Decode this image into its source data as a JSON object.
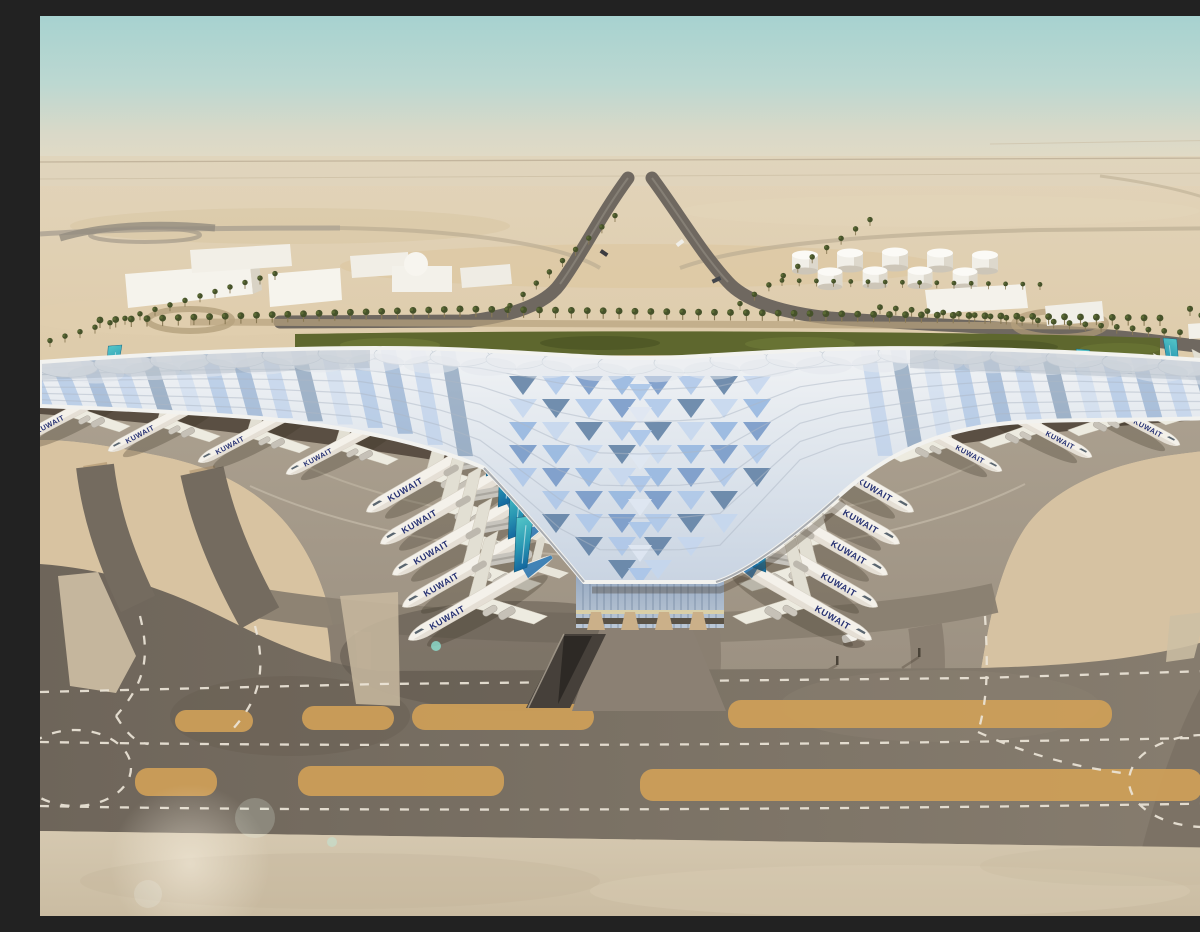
{
  "meta": {
    "title": "Aerial rendering of a desert airport terminal",
    "description": "Architectural visualization: trefoil terminal with swooping photovoltaic roof, Kuwait Airways aircraft at gates, palm-lined approach roads, desert horizon, taxiways in foreground"
  },
  "scene": {
    "airline_title": "KUWAIT",
    "palette": {
      "sky_top": "#a7d2d0",
      "sky_haze": "#ded8c6",
      "desert": "#ddc9a8",
      "desert_gold": "#d9bd92",
      "hedge_green": "#5e672e",
      "palm_green": "#46522a",
      "roof_silver": "#e9ecef",
      "roof_wing_gray": "#97a2b0",
      "apron_concrete": "#a59a8a",
      "taxiway_asphalt": "#786f63",
      "runway_gold": "#cf9f58",
      "sand_wedge": "#d8c3a1",
      "canopy_shadow": "#4c4136",
      "structure_tan": "#c9a46d",
      "fin_teal": "#3fb6ba",
      "fin_deep_blue": "#146ba3",
      "livery_navy": "#273273",
      "roof_blues": [
        "#8fb2de",
        "#6e93c4",
        "#a9c4e8",
        "#57799f",
        "#c3d6ee"
      ]
    },
    "aircraft": {
      "groups": [
        {
          "name": "left-center-gates",
          "dir": "left",
          "rot": -30,
          "scale": 1.12,
          "bridge": true,
          "positions": [
            [
              402,
              452
            ],
            [
              416,
              484
            ],
            [
              428,
              515
            ],
            [
              438,
              547
            ],
            [
              444,
              580
            ]
          ]
        },
        {
          "name": "right-center-gates",
          "dir": "right",
          "rot": 30,
          "scale": 1.12,
          "bridge": true,
          "positions": [
            [
              798,
              452
            ],
            [
              784,
              484
            ],
            [
              772,
              515
            ],
            [
              762,
              547
            ],
            [
              756,
              580
            ]
          ]
        },
        {
          "name": "left-wing-gates",
          "dir": "left",
          "rot": -28,
          "scale": 0.9,
          "bridge": true,
          "positions": [
            [
              40,
              392
            ],
            [
              130,
              402
            ],
            [
              220,
              413
            ],
            [
              308,
              425
            ]
          ]
        },
        {
          "name": "right-wing-gates",
          "dir": "right",
          "rot": 28,
          "scale": 0.9,
          "bridge": true,
          "positions": [
            [
              1165,
              385
            ],
            [
              1078,
              396
            ],
            [
              990,
              408
            ],
            [
              900,
              422
            ]
          ]
        }
      ]
    },
    "vegetation": {
      "palm_rows": [
        {
          "from": [
            60,
            312
          ],
          "to": [
            420,
            301
          ],
          "count": 24,
          "scale": 1.0
        },
        {
          "from": [
            420,
            301
          ],
          "to": [
            1120,
            310
          ],
          "count": 45,
          "scale": 1.0
        },
        {
          "from": [
            10,
            331
          ],
          "to": [
            235,
            264
          ],
          "count": 16,
          "scale": 0.8
        },
        {
          "from": [
            470,
            296
          ],
          "to": [
            575,
            206
          ],
          "count": 9,
          "scale": 0.8
        },
        {
          "from": [
            700,
            294
          ],
          "to": [
            830,
            210
          ],
          "count": 10,
          "scale": 0.8
        },
        {
          "from": [
            840,
            298
          ],
          "to": [
            1140,
            323
          ],
          "count": 20,
          "scale": 0.85
        },
        {
          "from": [
            742,
            270
          ],
          "to": [
            1000,
            274
          ],
          "count": 16,
          "scale": 0.7
        },
        {
          "from": [
            1150,
            300
          ],
          "to": [
            1196,
            326
          ],
          "count": 5,
          "scale": 0.9
        }
      ]
    },
    "ground_features": {
      "gold_strips": [
        [
          135,
          694,
          78,
          22
        ],
        [
          262,
          690,
          92,
          24
        ],
        [
          372,
          688,
          182,
          26
        ],
        [
          688,
          684,
          384,
          28
        ],
        [
          95,
          752,
          82,
          28
        ],
        [
          258,
          750,
          206,
          30
        ],
        [
          600,
          753,
          562,
          32
        ]
      ]
    }
  }
}
